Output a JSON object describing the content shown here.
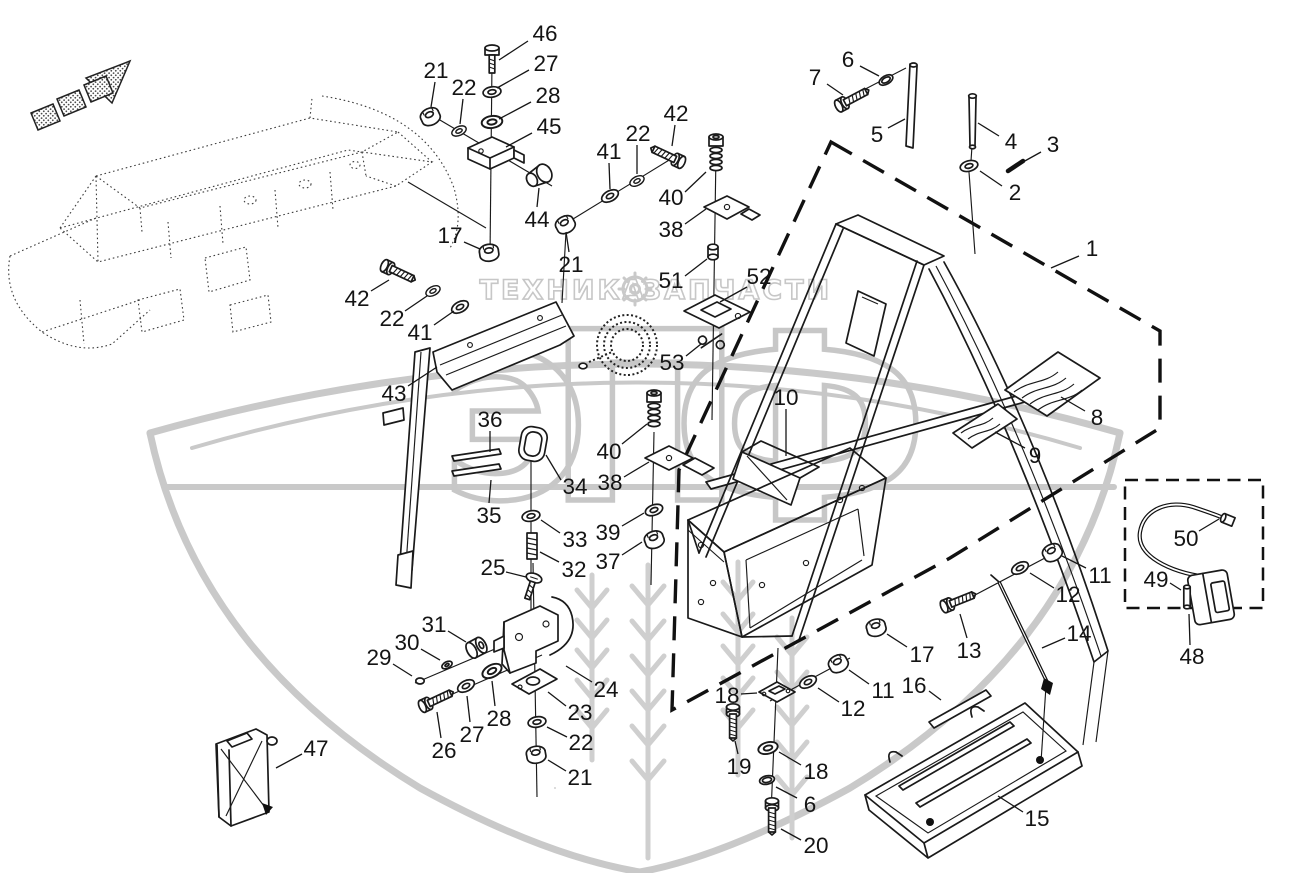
{
  "watermark": {
    "letters": [
      "Э",
      "П",
      "Ф"
    ],
    "line1_left": "ТЕХНИКА",
    "line1_right": "ЗАПЧАСТИ",
    "gear_icon": "gear",
    "color": "#c7c7c7"
  },
  "diagram": {
    "type": "exploded-parts-diagram",
    "line_color": "#1a1a1a",
    "boundary_style": "dashed",
    "callouts": [
      {
        "n": "46",
        "x": 545,
        "y": 33,
        "l": [
          528,
          41,
          499,
          60
        ]
      },
      {
        "n": "27",
        "x": 546,
        "y": 63,
        "l": [
          529,
          70,
          497,
          88
        ]
      },
      {
        "n": "28",
        "x": 548,
        "y": 95,
        "l": [
          531,
          102,
          499,
          119
        ]
      },
      {
        "n": "45",
        "x": 549,
        "y": 126,
        "l": [
          532,
          133,
          506,
          147
        ]
      },
      {
        "n": "21",
        "x": 436,
        "y": 70,
        "l": [
          435,
          82,
          431,
          107
        ]
      },
      {
        "n": "22",
        "x": 464,
        "y": 87,
        "l": [
          463,
          99,
          460,
          124
        ]
      },
      {
        "n": "44",
        "x": 537,
        "y": 219,
        "l": [
          537,
          207,
          539,
          188
        ]
      },
      {
        "n": "17",
        "x": 450,
        "y": 235,
        "l": [
          464,
          242,
          480,
          249
        ]
      },
      {
        "n": "21",
        "x": 571,
        "y": 264,
        "l": [
          569,
          252,
          566,
          232
        ]
      },
      {
        "n": "41",
        "x": 609,
        "y": 151,
        "l": [
          609,
          163,
          610,
          189
        ]
      },
      {
        "n": "22",
        "x": 638,
        "y": 133,
        "l": [
          637,
          145,
          637,
          174
        ]
      },
      {
        "n": "42",
        "x": 676,
        "y": 113,
        "l": [
          675,
          125,
          672,
          146
        ]
      },
      {
        "n": "40",
        "x": 671,
        "y": 197,
        "l": [
          685,
          192,
          706,
          172
        ]
      },
      {
        "n": "38",
        "x": 671,
        "y": 229,
        "l": [
          685,
          224,
          706,
          209
        ]
      },
      {
        "n": "6",
        "x": 848,
        "y": 59,
        "l": [
          860,
          66,
          879,
          76
        ]
      },
      {
        "n": "7",
        "x": 815,
        "y": 77,
        "l": [
          827,
          84,
          843,
          95
        ]
      },
      {
        "n": "5",
        "x": 877,
        "y": 134,
        "l": [
          888,
          128,
          905,
          119
        ]
      },
      {
        "n": "4",
        "x": 1011,
        "y": 141,
        "l": [
          999,
          136,
          978,
          123
        ]
      },
      {
        "n": "3",
        "x": 1053,
        "y": 144,
        "l": [
          1041,
          152,
          1023,
          162
        ]
      },
      {
        "n": "2",
        "x": 1015,
        "y": 192,
        "l": [
          1002,
          186,
          980,
          171
        ]
      },
      {
        "n": "1",
        "x": 1092,
        "y": 248,
        "l": [
          1079,
          256,
          1051,
          268
        ]
      },
      {
        "n": "51",
        "x": 671,
        "y": 280,
        "l": [
          685,
          276,
          707,
          259
        ]
      },
      {
        "n": "52",
        "x": 759,
        "y": 276,
        "l": [
          747,
          287,
          720,
          302
        ]
      },
      {
        "n": "53",
        "x": 672,
        "y": 362,
        "l": [
          686,
          356,
          701,
          344
        ]
      },
      {
        "n": "42",
        "x": 357,
        "y": 298,
        "l": [
          371,
          291,
          389,
          280
        ]
      },
      {
        "n": "22",
        "x": 392,
        "y": 318,
        "l": [
          405,
          311,
          427,
          296
        ]
      },
      {
        "n": "41",
        "x": 420,
        "y": 332,
        "l": [
          434,
          325,
          454,
          311
        ]
      },
      {
        "n": "43",
        "x": 394,
        "y": 393,
        "l": [
          408,
          386,
          437,
          367
        ]
      },
      {
        "n": "36",
        "x": 490,
        "y": 419,
        "l": [
          490,
          431,
          490,
          452
        ]
      },
      {
        "n": "35",
        "x": 489,
        "y": 515,
        "l": [
          489,
          503,
          491,
          480
        ]
      },
      {
        "n": "34",
        "x": 575,
        "y": 486,
        "l": [
          561,
          480,
          546,
          455
        ]
      },
      {
        "n": "33",
        "x": 575,
        "y": 539,
        "l": [
          560,
          533,
          541,
          520
        ]
      },
      {
        "n": "32",
        "x": 574,
        "y": 569,
        "l": [
          559,
          562,
          540,
          552
        ]
      },
      {
        "n": "25",
        "x": 493,
        "y": 567,
        "l": [
          506,
          572,
          526,
          577
        ]
      },
      {
        "n": "40",
        "x": 609,
        "y": 451,
        "l": [
          622,
          444,
          647,
          424
        ]
      },
      {
        "n": "38",
        "x": 610,
        "y": 482,
        "l": [
          624,
          477,
          649,
          462
        ]
      },
      {
        "n": "39",
        "x": 608,
        "y": 532,
        "l": [
          622,
          526,
          644,
          513
        ]
      },
      {
        "n": "37",
        "x": 608,
        "y": 561,
        "l": [
          622,
          555,
          642,
          542
        ]
      },
      {
        "n": "10",
        "x": 786,
        "y": 397,
        "l": [
          786,
          409,
          786,
          456
        ]
      },
      {
        "n": "8",
        "x": 1097,
        "y": 417,
        "l": [
          1085,
          411,
          1061,
          397
        ]
      },
      {
        "n": "9",
        "x": 1035,
        "y": 455,
        "l": [
          1025,
          448,
          995,
          432
        ]
      },
      {
        "n": "31",
        "x": 434,
        "y": 624,
        "l": [
          448,
          631,
          466,
          642
        ]
      },
      {
        "n": "30",
        "x": 407,
        "y": 642,
        "l": [
          421,
          649,
          440,
          660
        ]
      },
      {
        "n": "29",
        "x": 379,
        "y": 657,
        "l": [
          393,
          664,
          412,
          676
        ]
      },
      {
        "n": "26",
        "x": 444,
        "y": 750,
        "l": [
          441,
          738,
          437,
          712
        ]
      },
      {
        "n": "27",
        "x": 472,
        "y": 734,
        "l": [
          470,
          722,
          467,
          696
        ]
      },
      {
        "n": "28",
        "x": 499,
        "y": 718,
        "l": [
          495,
          706,
          492,
          681
        ]
      },
      {
        "n": "24",
        "x": 606,
        "y": 689,
        "l": [
          592,
          682,
          566,
          666
        ]
      },
      {
        "n": "23",
        "x": 580,
        "y": 712,
        "l": [
          566,
          706,
          548,
          692
        ]
      },
      {
        "n": "22",
        "x": 581,
        "y": 742,
        "l": [
          567,
          737,
          547,
          727
        ]
      },
      {
        "n": "21",
        "x": 580,
        "y": 777,
        "l": [
          566,
          771,
          548,
          760
        ]
      },
      {
        "n": "47",
        "x": 316,
        "y": 748,
        "l": [
          302,
          754,
          276,
          768
        ]
      },
      {
        "n": "17",
        "x": 922,
        "y": 654,
        "l": [
          907,
          647,
          887,
          634
        ]
      },
      {
        "n": "13",
        "x": 969,
        "y": 650,
        "l": [
          967,
          638,
          960,
          614
        ]
      },
      {
        "n": "11",
        "x": 1100,
        "y": 575,
        "l": [
          1086,
          568,
          1062,
          556
        ]
      },
      {
        "n": "12",
        "x": 1068,
        "y": 594,
        "l": [
          1054,
          588,
          1030,
          573
        ]
      },
      {
        "n": "14",
        "x": 1079,
        "y": 633,
        "l": [
          1065,
          638,
          1042,
          648
        ]
      },
      {
        "n": "16",
        "x": 914,
        "y": 685,
        "l": [
          929,
          691,
          941,
          700
        ]
      },
      {
        "n": "11",
        "x": 883,
        "y": 690,
        "l": [
          869,
          684,
          849,
          670
        ]
      },
      {
        "n": "12",
        "x": 853,
        "y": 708,
        "l": [
          839,
          702,
          818,
          688
        ]
      },
      {
        "n": "18",
        "x": 727,
        "y": 695,
        "l": [
          741,
          694,
          757,
          693
        ]
      },
      {
        "n": "19",
        "x": 739,
        "y": 766,
        "l": [
          738,
          754,
          735,
          741
        ]
      },
      {
        "n": "18",
        "x": 816,
        "y": 771,
        "l": [
          801,
          765,
          779,
          752
        ]
      },
      {
        "n": "6",
        "x": 810,
        "y": 804,
        "l": [
          797,
          798,
          776,
          787
        ]
      },
      {
        "n": "20",
        "x": 816,
        "y": 845,
        "l": [
          801,
          840,
          781,
          829
        ]
      },
      {
        "n": "15",
        "x": 1037,
        "y": 818,
        "l": [
          1023,
          812,
          998,
          796
        ]
      },
      {
        "n": "50",
        "x": 1186,
        "y": 538,
        "l": [
          1199,
          531,
          1219,
          519
        ]
      },
      {
        "n": "49",
        "x": 1156,
        "y": 579,
        "l": [
          1170,
          583,
          1181,
          590
        ]
      },
      {
        "n": "48",
        "x": 1192,
        "y": 656,
        "l": [
          1190,
          645,
          1189,
          614
        ]
      }
    ]
  }
}
